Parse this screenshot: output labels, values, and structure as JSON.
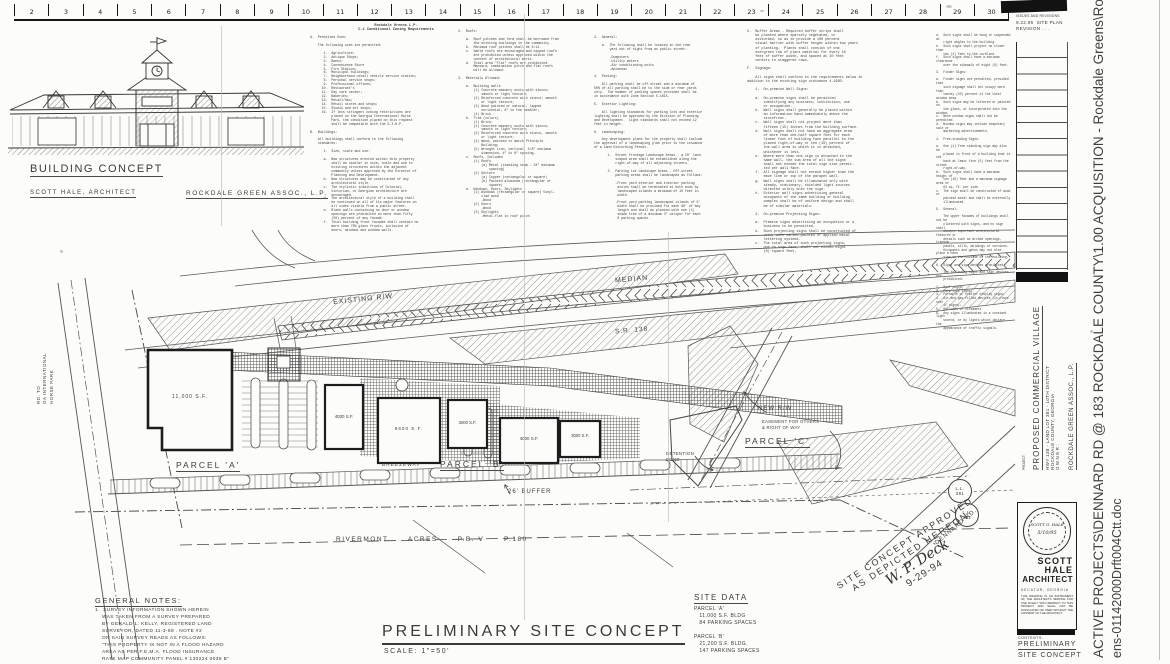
{
  "ruler": {
    "numbers": [
      "2",
      "3",
      "4",
      "5",
      "6",
      "7",
      "8",
      "9",
      "10",
      "11",
      "12",
      "13",
      "14",
      "15",
      "16",
      "17",
      "18",
      "19",
      "20",
      "21",
      "22",
      "23",
      "24",
      "25",
      "26",
      "27",
      "28",
      "29",
      "30"
    ]
  },
  "sketch": {
    "title": "BUILDING CONCEPT",
    "architect": "SCOTT HALE, ARCHITECT",
    "owner": "ROCKDALE GREEN ASSOC., L.P."
  },
  "zoning": {
    "header": "Rockdale Greens L.P.\nC-1 Conditional Zoning Requirements",
    "col1": "A.  Permitted Uses:\n\n    The following uses are permitted:\n\n       1.  Agriculture;\n       2.  Antique Shops;\n       3.  Banks;\n       4.  Convenience Store\n       5.  Fire Station;\n       6.  Municipal buildings;\n       7.  Neighborhood retail vehicle service station;\n       8.  Personal service shops;\n       9.  Professional offices;\n      10.  Restaurant's\n      11.  Day care center;\n      12.  Bakeries;\n      13.  Retail/Gas;\n      14.  Retail stores and shops;\n      15.  Studio and art shops;\n      16.  If less stringent zoning restrictions are\n           placed on the Georgia International Horse\n           Park, the condition placed on this request\n           shall be compatible with the G.I.H.P.\n\nB.  Buildings:\n\n    All buildings shall conform to the following\n    standards:\n\n       1.  Size, scale and use:\n\n       a.  New structures erected within this property\n           shall be similar in size, scale and use to\n           existing structures within the adjacent\n           community unless approved by the Director of\n           Planning and Development.\n       b.  New structures may be constructed of any\n           architectural style.\n       c.  The stylistic traditions of Colonial,\n           Victorian, or Georgian architecture are\n           encouraged.\n       d.  The architectural style of a building shall\n           be continued on all of its major features on\n           all sides visible from a public street.\n       e.  Blank walls containing no door or window\n           openings are prohibited on more than fifty\n           (50) percent of any facade.\n       f.  Total building front facades shall contain no\n           more than 75% glass fronts, inclusive of\n           doors, windows and window walls.",
    "col2": "2.  Roofs:\n\n    a.  Roof pitches and form shall be borrowed from\n        the existing buildings in the community.\n    b.  Minimum roof pitches shall be 6:12.\n    c.  Gable roofs are encouraged and hipped roofs\n        are prohibited unless approved within the\n        context of architectural merit.\n    d.  Total area \"flat\" roofs are prohibited.\n        Mansard, combination pitch and flat roofs\n        will be allowed.\n\n3.  Materials Allowed:\n\n    a.  Building walls\n        (1) Concrete masonry units with stucco;\n            smooth or light texture;\n        (2) Reinforced concrete with stucco; smooth\n            or light texture;\n        (3) Wood painted or natural, lapped\n            horizontal, 8\" to the weather;\n        (4) Brick.\n    b.  Trim (colors)\n        (1) Brick;\n        (2) Concrete masonry units with stucco,\n            smooth or light texture;\n        (3) Reinforced concrete with stucco, smooth\n            or light texture;\n        (4) Wood, painted to match Principle\n            Building;\n        (5) Wrought iron, vertical, 5/8\" minimum\n            dimension, 4\" to 8\" spacing.\n    c.  Roofs, Included\n        (1) Roofs\n            (a) Metal (standing seam - 24\" minimum\n                spacing)\n        (2) Gutters\n            (a) Copper (rectangular or square)\n            (b) Painted aluminum (rectangular or\n                square)\n    d.  Windows, Doors, Skylights\n        (1) Windows (rectangular or square) Vinyl-\n            clad wood\n            -Wood\n        (2) Doors\n            -Wood\n        (3) Skylights\n            -Metal-flat to roof pitch",
    "col3": "3.  General:\n\n    a.  The following shall be located in the rear\n        yard out of sight from as public street:\n\n        -Dumpsters\n        -Utility meters\n        -Air conditioning units\n        -Antennas\n\n4.  Parking:\n\n    All parking shall be off-street and a minimum of\n50% of all parking shall be to the side or rear yards\nonly.  The number of parking spaces provided shall be\nin accordance with Zone Section 5-1615.\n\n5.  Exterior Lighting:\n\n    All lighting standards for parking lots and exterior\nlighting shall be approved by the Division of Planning\nand Development.  Light standards shall not exceed 12\nfeet in height.\n\n6.  Landscaping:\n\n    Any development plans for the property shall include\nthe approval of a landscaping plan prior to the issuance\nof a Land Disturbing Permit.\n\n       1.  Street Frontage Landscape Areas - a 10' land-\n           scaped area shall be established along the\n           right-of-way of all adjoining streets.\n\n       2.  Parking Lot Landscape Areas - Off-street\n           parking areas shall be landscaped as follows:\n\n           -Front yard exterior and interior parking\n            aisles shall be terminated at both ends by\n            landscaped islands a minimum of 10 feet in\n            width.\n\n           -Front yard parking landscaped islands of 5'\n            width shall be provided for each 90' of bay\n            length and shall be planted with one (1)\n            shade tree of a minimum 3\" caliper for each\n            8 parking spaces.",
    "col4": "5.  Buffer Areas - Required buffer strips shall\n    be planted where sparsely vegetated, or\n    disturbed, so as to provide a 100 percent\n    visual barrier with buffer height within two years\n    of planting.  Plants shall consist of one\n    evergreen row of plant material for every 10\n    feet of buffer width, and spaced at 10 feet\n    centers in staggered rows.\n\nF.  Signage:\n\n    All signs shall conform to the requirements below in\naddition to the existing sign ordinance 4-1985:\n\n    1.  On-premise Wall Signs:\n\n    a.  On-premise signs shall be permitted\n        identifying any business, institution, use\n        or occupation.\n    b.  Wall signs shall generally be placed within\n        an information band immediately above the\n        storefront.\n    c.  Wall signs shall not project more than\n        fifteen (15) inches from the building surface.\n    d.  Wall signs shall not have an aggregate area\n        of more than one-half square foot for each\n        linear foot of building face parallel to the\n        placed right-of-way or ten (10) percent of\n        the wall area to which it is attached,\n        whichever is less.\n    e.  Where more than one sign is attached to the\n        same wall, the sum area of all the signs\n        shall not exceed the total sign size permit-\n        ted per wall face.\n    f.  All signage shall not extend higher than the\n        eave line or top of the parapet wall.\n    g.  Wall signs shall be illuminated only with\n        steady, stationary, shielded light sources\n        directed solely onto the sign.\n    h.  Exterior wall signs advertising general\n        occupants of the same building or building\n        complex shall be of uniform design and shall\n        be of similar materials.\n\n    2.  On-premise Projecting Signs:\n\n    a.  Premise signs advertising an occupation or a\n        business to be permitted.\n    b.  Such projecting signs shall be constructed of\n        wood, with carved painted or applied metal\n        lettering systems.\n    c.  The total area of such projecting signs,\n        one on sign face, shall not exceed eight\n        (8) square feet.",
    "col5": "d.  Such signs shall be hung or suspended at\n    right angles to the building.\ne.  Such signs shall project no closer than\n    two (2) feet to the curbline.\nf.  Such signs shall have a minimum clearance\n    over the sidewalk of eight (8) feet.\n\n3.  Finder Signs:\n\na.  Finder signs are permitted, provided that\n    such signage shall not occupy more than\n    twenty (20) percent of the total window area.\nb.  Such signs may be lettered or painted on\n    the glass, or incorporated into the window.\nc.  Neon window signs shall not be permitted.\nd.  Window signs may include temporary sale or\n    marketing advertisements.\n\n4.  Free-standing Signs:\n\na.  One (1) free-standing sign may also be\n    placed in front of a building that is set\n    back at least five (5) feet from the street\n    right-of-way.\nb.  Such signs shall have a maximum height of\n    ten (10) feet and a maximum signage area of\n    64 sq. ft. per side.\nc.  The sign shall be constructed of wood or\n    painted metal and shall be externally\n    illuminated.\n\n5.  General:\n\n    The upper facades of buildings shall not be\n    cluttered with signs, and no sign shall\n    obscure important architectural features or\n    details such as arched openings, transom\n    panels, sills, moldings or cornices.\n    Occupants and gates may not else place a neon\n    sign on the outside of the building.\n\n6.  Signs and sign devices prohibited:\n\n    The following signs and sign devices are\n    prohibited:\n\n1.  Roof signs;\n2.  Park type signs;\n3.  Portable or trailer display signs;\n4.  Air and gas-filled devices (in place over\n    if signs);\n5.  Balloons or streamers\n6.  Any signs illuminated in a constant light\n    source, or by lights which imitate the\n    appearance of traffic signals."
  },
  "plan": {
    "labels": {
      "existing_rw": "EXISTING R/W",
      "median": "MEDIAN",
      "sr138": "S.R. 138",
      "road_left": "RD. TO\nGA INTERNATIONAL\nHORSE PARK",
      "parcel_a": "PARCEL 'A'",
      "parcel_b": "PARCEL 'B'",
      "parcel_c": "PARCEL 'C'",
      "breezeway": "BREEZEWAY",
      "bldg1": "11,000 S.F.",
      "bldg2": "4000 S.F.",
      "bldg3": "8600 S.F.",
      "bldg4": "3000 S.F.",
      "bldg5": "4000 S.F.",
      "bldg6": "3000 S.F.",
      "new_rw": "NEW R/W",
      "easement": "EASEMENT FOR OTHERS\n& RIGHT OF WAY",
      "detention": "DETENTION\nPOND",
      "buffer": "26' BUFFER",
      "rivermont": "RIVERMONT      ACRES      P.B. V      P.180",
      "ll381": "L.L.\n381",
      "ll382": "L.L.\n382",
      "dennard": "DENNARD RD."
    }
  },
  "notes": {
    "title": "GENERAL NOTES:",
    "body": "1.  SURVEY INFORMATION SHOWN HEREIN\n    WAS TAKEN FROM A SURVEY PREPARED\n    BY GERALD L. KELLY, REGISTERED LAND\n    SURVEYOR, DATED 11-3-88 . NOTE #2\n    ON SAID SURVEY READS AS FOLLOWS:\n    \"THIS PROPERTY IS NOT IN A FLOOD HAZARD\n    AREA AS PER F.E.M.A. FLOOD INSURANCE\n    RATE MAP COMMUNITY PANEL # 130224 0035 B\""
  },
  "title_main": {
    "text": "PRELIMINARY SITE CONCEPT",
    "scale": "SCALE: 1\"=50'"
  },
  "site_data": {
    "title": "SITE DATA",
    "body": "PARCEL 'A'\n   11,000 S.F. BLDG\n   84 PARKING SPACES\n\nPARCEL 'B'\n   21,200 S.F. BLDG.\n   147 PARKING SPACES"
  },
  "approval": {
    "line1": "SITE CONCEPT APPROVED",
    "line2": "AS DEPICTED HEREON",
    "signature": "W. P. Deck",
    "date": "9-29-94"
  },
  "titleblock": {
    "issues_header": "ISSUES AND REVISIONS",
    "revision_entry": "9.22.95  SITE PLAN\nREVISION . . .",
    "project_label": "PROJECT:",
    "project_name": "PROPOSED COMMERCIAL VILLAGE",
    "project_line2": "HWY 138 - LAND LOT 381 - 10TH DISTRICT",
    "project_line3": "ROCKDALE COUNTY, GEORGIA",
    "owner_label": "OWNER:",
    "owner_name": "ROCKDALE GREEN ASSOC., L.P.",
    "seal_name": "SCOTT G. HALE",
    "seal_date": "5/10/95",
    "firm_line1": "SCOTT",
    "firm_line2": "HALE",
    "firm_line3": "ARCHITECT",
    "firm_city": "DECATUR, GEORGIA",
    "disclaimer": "THIS DRAWING IS AN INSTRUMENT OF THE ARCHITECTS SERVICE FOR USE SOLELY WITH RESPECT TO THIS PROJECT AND SHALL NOT BE DUPLICATED OR USED WITHOUT THE CONSENT OF THE ARCHITECT.",
    "contents_label": "CONTENTS:",
    "contents_line1": "PRELIMINARY",
    "contents_line2": "SITE CONCEPT"
  },
  "watermark": {
    "line1": "ACTIVE PROJECTS\\DENNARD RD @ 183 ROCKDALE COUNTY\\1.00 ACQUISITION - Rockdale Greens\\Rockdale",
    "line2": "ens-01142000Drft004Ctt.doc"
  }
}
